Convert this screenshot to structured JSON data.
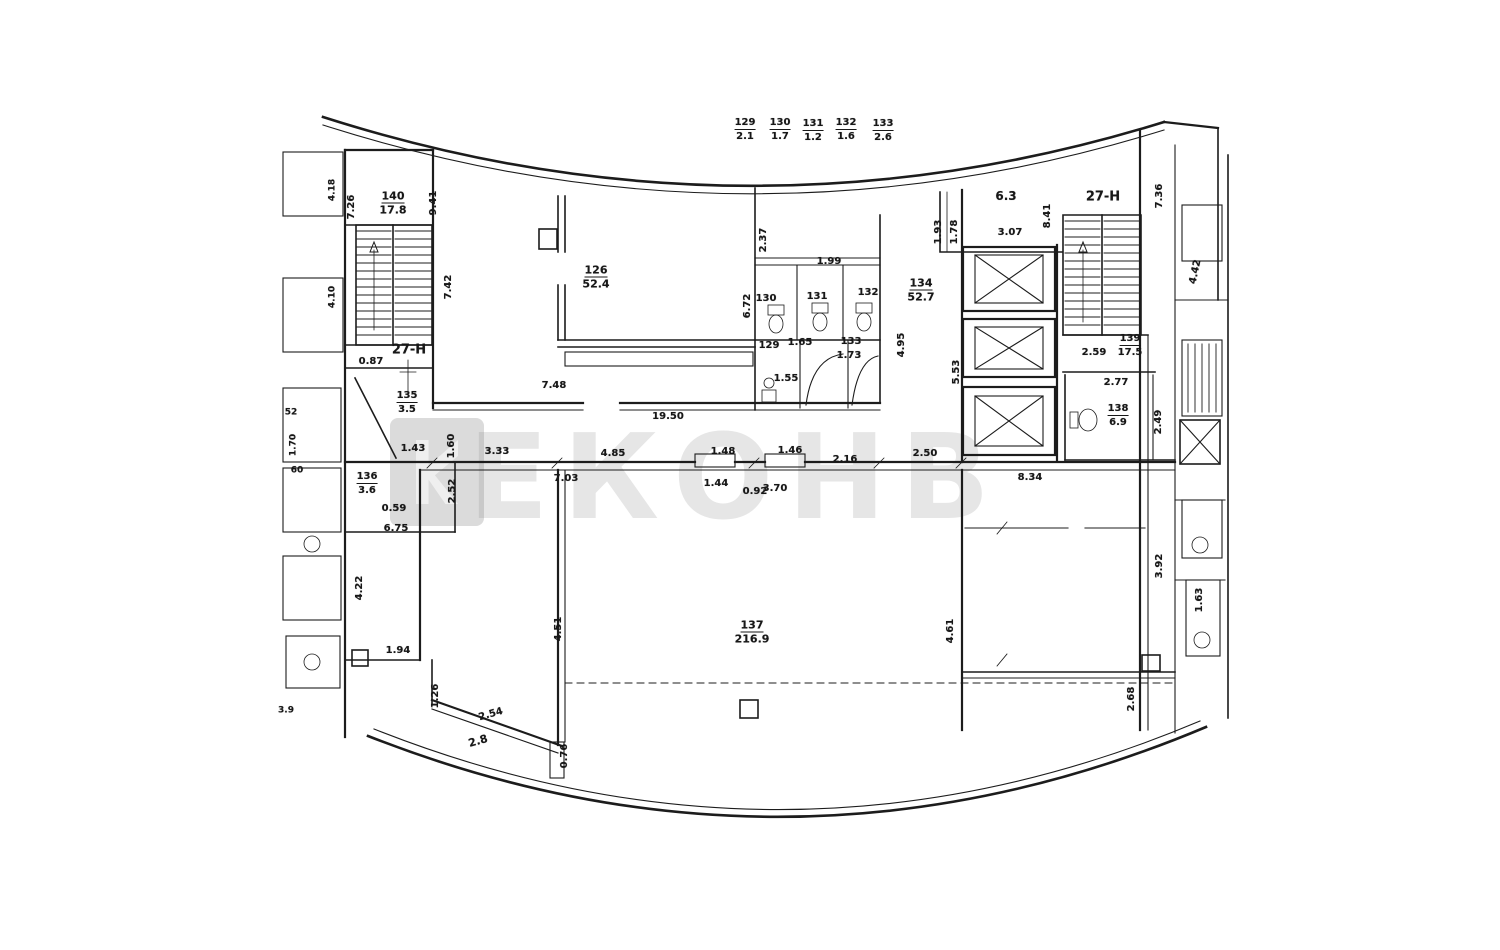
{
  "watermark": {
    "text": "ЕКОНВ",
    "color": "rgba(130,130,130,0.20)"
  },
  "legend": {
    "rooms": [
      "129",
      "130",
      "131",
      "132",
      "133"
    ],
    "areas": [
      "2.1",
      "1.7",
      "1.2",
      "1.6",
      "2.6"
    ]
  },
  "zones": [
    "27-Н",
    "27-Н"
  ],
  "rooms": [
    {
      "id": "126",
      "area": "52.4"
    },
    {
      "id": "134",
      "area": "52.7"
    },
    {
      "id": "137",
      "area": "216.9"
    },
    {
      "id": "140",
      "area": "17.8"
    },
    {
      "id": "139",
      "area": "17.5"
    },
    {
      "id": "138",
      "area": "6.9"
    },
    {
      "id": "135",
      "area": "3.5"
    },
    {
      "id": "136",
      "area": "3.6"
    },
    {
      "id": "129"
    },
    {
      "id": "130"
    },
    {
      "id": "131"
    },
    {
      "id": "132"
    },
    {
      "id": "133"
    },
    {
      "id": "6.3"
    },
    {
      "id": "2.8"
    }
  ],
  "labels": [
    {
      "n": "legend-room-number",
      "t": "129",
      "x": 745,
      "y": 124,
      "u": true
    },
    {
      "n": "legend-room-area",
      "t": "2.1",
      "x": 745,
      "y": 137
    },
    {
      "n": "legend-room-number",
      "t": "130",
      "x": 780,
      "y": 124,
      "u": true
    },
    {
      "n": "legend-room-area",
      "t": "1.7",
      "x": 780,
      "y": 137
    },
    {
      "n": "legend-room-number",
      "t": "131",
      "x": 813,
      "y": 125,
      "u": true
    },
    {
      "n": "legend-room-area",
      "t": "1.2",
      "x": 813,
      "y": 138
    },
    {
      "n": "legend-room-number",
      "t": "132",
      "x": 846,
      "y": 124,
      "u": true
    },
    {
      "n": "legend-room-area",
      "t": "1.6",
      "x": 846,
      "y": 137
    },
    {
      "n": "legend-room-number",
      "t": "133",
      "x": 883,
      "y": 125,
      "u": true
    },
    {
      "n": "legend-room-area",
      "t": "2.6",
      "x": 883,
      "y": 138
    },
    {
      "n": "zone-label",
      "t": "27-Н",
      "x": 409,
      "y": 350,
      "fs": 13
    },
    {
      "n": "zone-label",
      "t": "27-Н",
      "x": 1103,
      "y": 197,
      "fs": 13
    },
    {
      "n": "room-number",
      "t": "140",
      "x": 393,
      "y": 197,
      "u": true,
      "fs": 11
    },
    {
      "n": "room-area",
      "t": "17.8",
      "x": 393,
      "y": 210,
      "fs": 11
    },
    {
      "n": "room-number",
      "t": "126",
      "x": 596,
      "y": 271,
      "u": true,
      "fs": 11
    },
    {
      "n": "room-area",
      "t": "52.4",
      "x": 596,
      "y": 284,
      "fs": 11
    },
    {
      "n": "room-number",
      "t": "134",
      "x": 921,
      "y": 284,
      "u": true,
      "fs": 11
    },
    {
      "n": "room-area",
      "t": "52.7",
      "x": 921,
      "y": 297,
      "fs": 11
    },
    {
      "n": "room-number",
      "t": "135",
      "x": 407,
      "y": 397,
      "u": true
    },
    {
      "n": "room-area",
      "t": "3.5",
      "x": 407,
      "y": 410
    },
    {
      "n": "room-number",
      "t": "136",
      "x": 367,
      "y": 478,
      "u": true
    },
    {
      "n": "room-area",
      "t": "3.6",
      "x": 367,
      "y": 491
    },
    {
      "n": "room-number",
      "t": "137",
      "x": 752,
      "y": 626,
      "u": true,
      "fs": 11
    },
    {
      "n": "room-area",
      "t": "216.9",
      "x": 752,
      "y": 639,
      "fs": 11
    },
    {
      "n": "room-number",
      "t": "138",
      "x": 1118,
      "y": 410,
      "u": true
    },
    {
      "n": "room-area",
      "t": "6.9",
      "x": 1118,
      "y": 423
    },
    {
      "n": "room-number",
      "t": "139",
      "x": 1130,
      "y": 340,
      "u": true
    },
    {
      "n": "room-area",
      "t": "17.5",
      "x": 1130,
      "y": 353
    },
    {
      "n": "room-area",
      "t": "6.3",
      "x": 1006,
      "y": 196,
      "fs": 12
    },
    {
      "n": "room-area",
      "t": "2.8",
      "x": 478,
      "y": 741,
      "r": -16,
      "fs": 11
    },
    {
      "n": "room-number",
      "t": "130",
      "x": 766,
      "y": 299
    },
    {
      "n": "room-number",
      "t": "131",
      "x": 817,
      "y": 297
    },
    {
      "n": "room-number",
      "t": "132",
      "x": 868,
      "y": 293
    },
    {
      "n": "room-number",
      "t": "129",
      "x": 769,
      "y": 346
    },
    {
      "n": "room-number",
      "t": "133",
      "x": 851,
      "y": 342
    },
    {
      "n": "dimension-label",
      "t": "7.26",
      "x": 352,
      "y": 207,
      "r": -90
    },
    {
      "n": "dimension-label",
      "t": "9.41",
      "x": 434,
      "y": 203,
      "r": -90
    },
    {
      "n": "dimension-label",
      "t": "7.42",
      "x": 449,
      "y": 287,
      "r": -90
    },
    {
      "n": "dimension-label",
      "t": "0.87",
      "x": 371,
      "y": 362
    },
    {
      "n": "dimension-label",
      "t": "2.37",
      "x": 764,
      "y": 240,
      "r": -90
    },
    {
      "n": "dimension-label",
      "t": "6.72",
      "x": 748,
      "y": 306,
      "r": -90
    },
    {
      "n": "dimension-label",
      "t": "1.99",
      "x": 829,
      "y": 262
    },
    {
      "n": "dimension-label",
      "t": "4.95",
      "x": 902,
      "y": 345,
      "r": -90
    },
    {
      "n": "dimension-label",
      "t": "5.53",
      "x": 957,
      "y": 372,
      "r": -90
    },
    {
      "n": "dimension-label",
      "t": "1.93",
      "x": 939,
      "y": 232,
      "r": -90
    },
    {
      "n": "dimension-label",
      "t": "1.78",
      "x": 955,
      "y": 232,
      "r": -90
    },
    {
      "n": "dimension-label",
      "t": "3.07",
      "x": 1010,
      "y": 233
    },
    {
      "n": "dimension-label",
      "t": "8.41",
      "x": 1048,
      "y": 216,
      "r": -90
    },
    {
      "n": "dimension-label",
      "t": "7.36",
      "x": 1160,
      "y": 196,
      "r": -90
    },
    {
      "n": "dimension-label",
      "t": "4.42",
      "x": 1196,
      "y": 272,
      "r": -78
    },
    {
      "n": "dimension-label",
      "t": "2.59",
      "x": 1094,
      "y": 353
    },
    {
      "n": "dimension-label",
      "t": "2.77",
      "x": 1116,
      "y": 383
    },
    {
      "n": "dimension-label",
      "t": "2.49",
      "x": 1159,
      "y": 422,
      "r": -90
    },
    {
      "n": "dimension-label",
      "t": "19.50",
      "x": 668,
      "y": 417
    },
    {
      "n": "dimension-label",
      "t": "7.48",
      "x": 554,
      "y": 386
    },
    {
      "n": "dimension-label",
      "t": "1.65",
      "x": 800,
      "y": 343
    },
    {
      "n": "dimension-label",
      "t": "1.73",
      "x": 849,
      "y": 356
    },
    {
      "n": "dimension-label",
      "t": "1.55",
      "x": 786,
      "y": 379
    },
    {
      "n": "dimension-label",
      "t": "1.43",
      "x": 413,
      "y": 449
    },
    {
      "n": "dimension-label",
      "t": "3.33",
      "x": 497,
      "y": 452
    },
    {
      "n": "dimension-label",
      "t": "4.85",
      "x": 613,
      "y": 454
    },
    {
      "n": "dimension-label",
      "t": "7.03",
      "x": 566,
      "y": 479
    },
    {
      "n": "dimension-label",
      "t": "1.48",
      "x": 723,
      "y": 452
    },
    {
      "n": "dimension-label",
      "t": "1.44",
      "x": 716,
      "y": 484
    },
    {
      "n": "dimension-label",
      "t": "0.92",
      "x": 755,
      "y": 492
    },
    {
      "n": "dimension-label",
      "t": "1.46",
      "x": 790,
      "y": 451
    },
    {
      "n": "dimension-label",
      "t": "3.70",
      "x": 775,
      "y": 489
    },
    {
      "n": "dimension-label",
      "t": "2.16",
      "x": 845,
      "y": 460
    },
    {
      "n": "dimension-label",
      "t": "2.50",
      "x": 925,
      "y": 454
    },
    {
      "n": "dimension-label",
      "t": "8.34",
      "x": 1030,
      "y": 478
    },
    {
      "n": "dimension-label",
      "t": "4.61",
      "x": 951,
      "y": 631,
      "r": -90
    },
    {
      "n": "dimension-label",
      "t": "3.92",
      "x": 1160,
      "y": 566,
      "r": -90
    },
    {
      "n": "dimension-label",
      "t": "2.68",
      "x": 1132,
      "y": 699,
      "r": -90
    },
    {
      "n": "dimension-label",
      "t": "1.63",
      "x": 1200,
      "y": 600,
      "r": -90
    },
    {
      "n": "dimension-label",
      "t": "4.22",
      "x": 360,
      "y": 588,
      "r": -90
    },
    {
      "n": "dimension-label",
      "t": "1.94",
      "x": 398,
      "y": 651
    },
    {
      "n": "dimension-label",
      "t": "1.26",
      "x": 436,
      "y": 696,
      "r": -90
    },
    {
      "n": "dimension-label",
      "t": "2.54",
      "x": 491,
      "y": 715,
      "r": -16
    },
    {
      "n": "dimension-label",
      "t": "0.76",
      "x": 565,
      "y": 756,
      "r": -90
    },
    {
      "n": "dimension-label",
      "t": "4.51",
      "x": 559,
      "y": 629,
      "r": -90
    },
    {
      "n": "dimension-label",
      "t": "1.60",
      "x": 452,
      "y": 446,
      "r": -90
    },
    {
      "n": "dimension-label",
      "t": "2.52",
      "x": 453,
      "y": 491,
      "r": -90
    },
    {
      "n": "dimension-label",
      "t": "0.59",
      "x": 394,
      "y": 509
    },
    {
      "n": "dimension-label",
      "t": "6.75",
      "x": 396,
      "y": 529
    },
    {
      "n": "dimension-label",
      "t": "52",
      "x": 291,
      "y": 413,
      "fs": 9
    },
    {
      "n": "dimension-label",
      "t": "1.70",
      "x": 294,
      "y": 445,
      "fs": 9,
      "r": -90
    },
    {
      "n": "dimension-label",
      "t": "60",
      "x": 297,
      "y": 471,
      "fs": 9
    },
    {
      "n": "dimension-label",
      "t": "3.9",
      "x": 286,
      "y": 711,
      "fs": 9
    },
    {
      "n": "dimension-label",
      "t": "4.18",
      "x": 333,
      "y": 190,
      "fs": 9,
      "r": -90
    },
    {
      "n": "dimension-label",
      "t": "4.10",
      "x": 333,
      "y": 297,
      "fs": 9,
      "r": -90
    }
  ]
}
